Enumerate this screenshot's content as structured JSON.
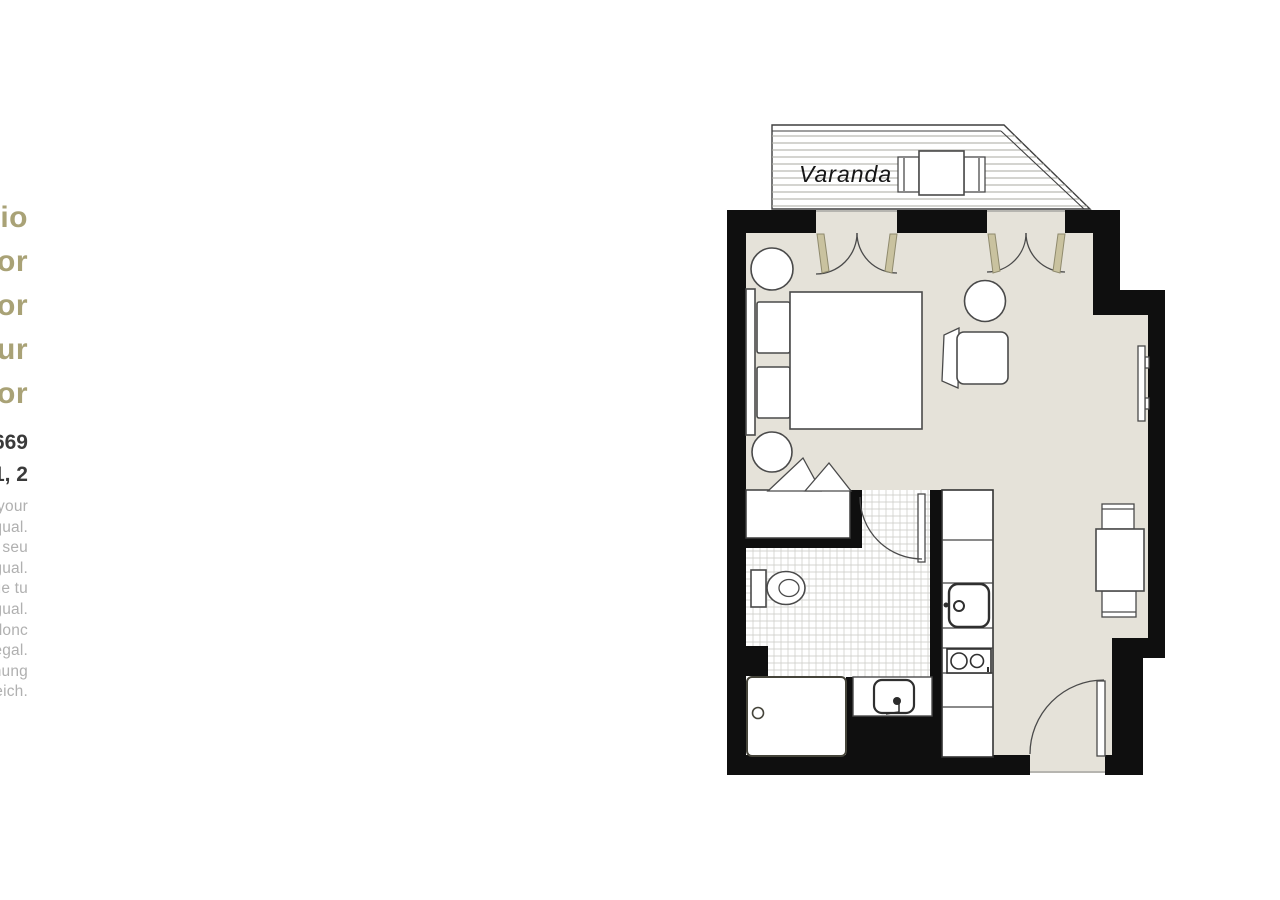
{
  "title": {
    "lines": [
      "Superior Studio",
      "Estúdio Superior",
      "Estudio Superior",
      "Studio Supérieur",
      "Studio Superior"
    ]
  },
  "address": {
    "separator": "·",
    "line1": [
      "Avenida 2",
      "Rua do Telhal, 63",
      "#2669"
    ],
    "line2": [
      "Floor",
      "Piso",
      "Étage",
      "Stock 1, 2"
    ]
  },
  "notes": {
    "lines": [
      "Note: this plan is an example of this type of unit, so your",
      "apartment may not be exactly equal.",
      "Obs: esta planta é um exemplo desta unidade, portanto o seu",
      "apartamento pode não ser exatamente igual.",
      "Nota: este plano es un ejemplo de esta unidad, por lo que tu",
      "apartamento puede no ser exactamente igual.",
      "Remarque : ce plan est un exemple de ce type d'unité, donc",
      "votre appartement peut ne pas être exactement égal.",
      "Hinweis: Dieser Plan ist ein Beispiel, daher ist Ihre Wohnung",
      "möglicherweise nicht genau gleich."
    ]
  },
  "plan": {
    "balcony_label": "Varanda"
  },
  "colors": {
    "title_olive": "#a9a276",
    "address_dark": "#3a3a3a",
    "note_gray": "#b0b0b0",
    "wall_black": "#0f0f0f",
    "floor_beige": "#e5e2d9",
    "door_jamb_olive": "#c9c29f",
    "tile_line_gray": "#c9c9c3"
  }
}
